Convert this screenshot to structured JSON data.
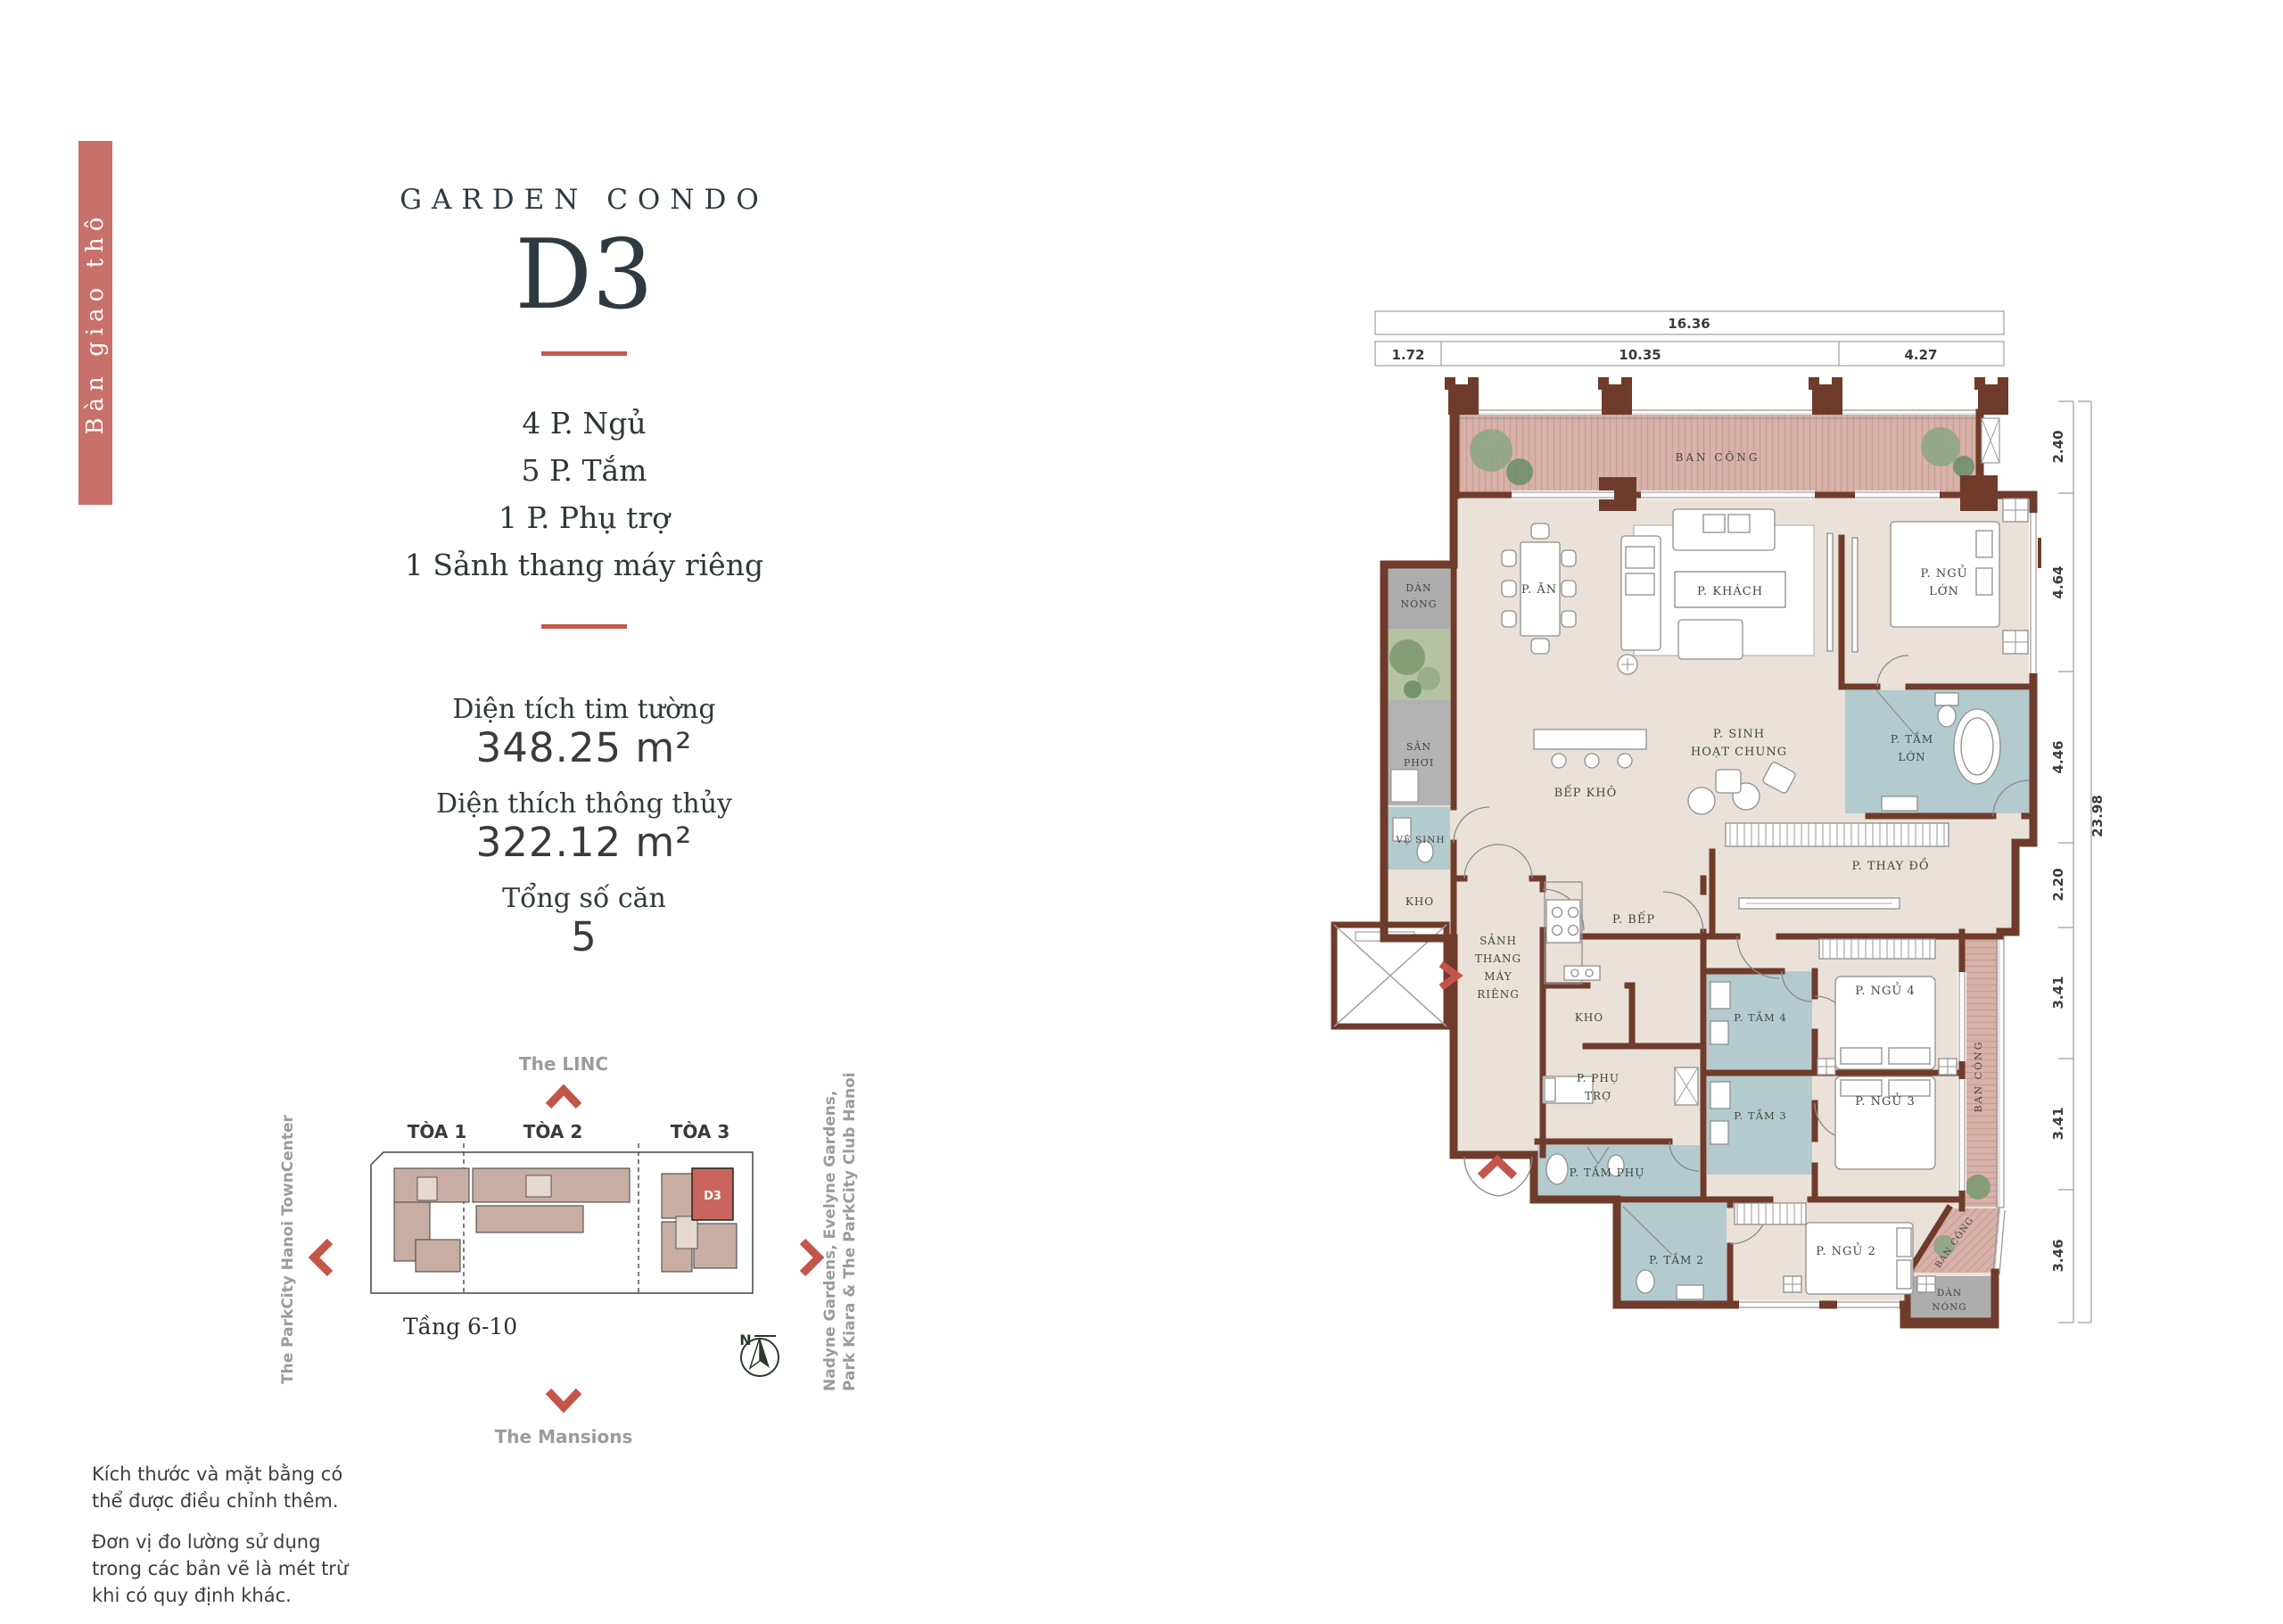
{
  "tag_bar": {
    "label": "Bàn giao thô",
    "bg_color": "#C7716A"
  },
  "header": {
    "eyebrow": "GARDEN CONDO",
    "unit": "D3"
  },
  "specs": {
    "line1": "4 P. Ngủ",
    "line2": "5 P. Tắm",
    "line3": "1 P. Phụ trợ",
    "line4": "1 Sảnh thang máy riêng"
  },
  "areas": [
    {
      "label": "Diện tích tim tường",
      "value": "348.25 m²"
    },
    {
      "label": "Diện thích thông thủy",
      "value": "322.12 m²"
    },
    {
      "label": "Tổng số căn",
      "value": "5"
    }
  ],
  "site_map": {
    "north_label": "The LINC",
    "south_label": "The Mansions",
    "west_label": "The ParkCity Hanoi TownCenter",
    "east_label_line1": "Nadyne Gardens, Evelyne Gardens,",
    "east_label_line2": "Park Kiara & The ParkCity Club Hanoi",
    "towers": [
      "TÒA 1",
      "TÒA 2",
      "TÒA 3"
    ],
    "floors": "Tầng 6-10",
    "highlight_unit": "D3",
    "compass_n": "N"
  },
  "disclaimers": [
    "Kích thước và mặt bằng có thể được điều chỉnh thêm.",
    "Đơn vị đo lường sử dụng trong các bản vẽ là mét trừ khi có quy định khác."
  ],
  "floor_plan": {
    "dims_top": {
      "total": "16.36",
      "segments": [
        "1.72",
        "10.35",
        "4.27"
      ]
    },
    "dims_right": {
      "total": "23.98",
      "segments": [
        "2.40",
        "4.64",
        "4.46",
        "2.20",
        "3.41",
        "3.41",
        "3.46"
      ]
    },
    "rooms": {
      "balcony": "BAN CÔNG",
      "dining": "P. ĂN",
      "living": "P. KHÁCH",
      "master_bed_l1": "P. NGỦ",
      "master_bed_l2": "LỚN",
      "ac_unit_l1": "DÀN",
      "ac_unit_l2": "NÓNG",
      "laundry_l1": "SÂN",
      "laundry_l2": "PHƠI",
      "wc": "VỆ SINH",
      "storage": "KHO",
      "dry_kitchen": "BẾP KHÔ",
      "family_l1": "P. SINH",
      "family_l2": "HOẠT CHUNG",
      "master_bath_l1": "P. TẮM",
      "master_bath_l2": "LỚN",
      "dressing": "P. THAY ĐỒ",
      "lift_lobby_l1": "SẢNH",
      "lift_lobby_l2": "THANG",
      "lift_lobby_l3": "MÁY",
      "lift_lobby_l4": "RIÊNG",
      "kitchen": "P. BẾP",
      "storage2": "KHO",
      "utility_l1": "P. PHỤ",
      "utility_l2": "TRỢ",
      "aux_bath": "P. TẮM PHỤ",
      "bath4": "P. TẮM 4",
      "bath3": "P. TẮM 3",
      "bed4": "P. NGỦ 4",
      "bed3": "P. NGỦ 3",
      "balcony2": "BAN CÔNG",
      "bath2": "P. TẮM 2",
      "bed2": "P. NGỦ 2",
      "balcony3": "BAN CÔNG",
      "ac_unit2_l1": "DÀN",
      "ac_unit2_l2": "NÓNG"
    }
  },
  "colors": {
    "accent_red": "#C4584E",
    "tag_red": "#C7716A",
    "wall_brown": "#6F3B2B",
    "floor_beige": "#EAE2D8",
    "balcony_pink": "#D8B2A9",
    "bath_blue": "#B3CBCF",
    "utility_gray": "#ADADAD",
    "plant_green": "#7E9B72",
    "map_building_tan": "#C8AEA2",
    "map_unit_red": "#C9655C",
    "label_dark": "#3E4840",
    "map_gray_text": "#9B9B9B"
  }
}
